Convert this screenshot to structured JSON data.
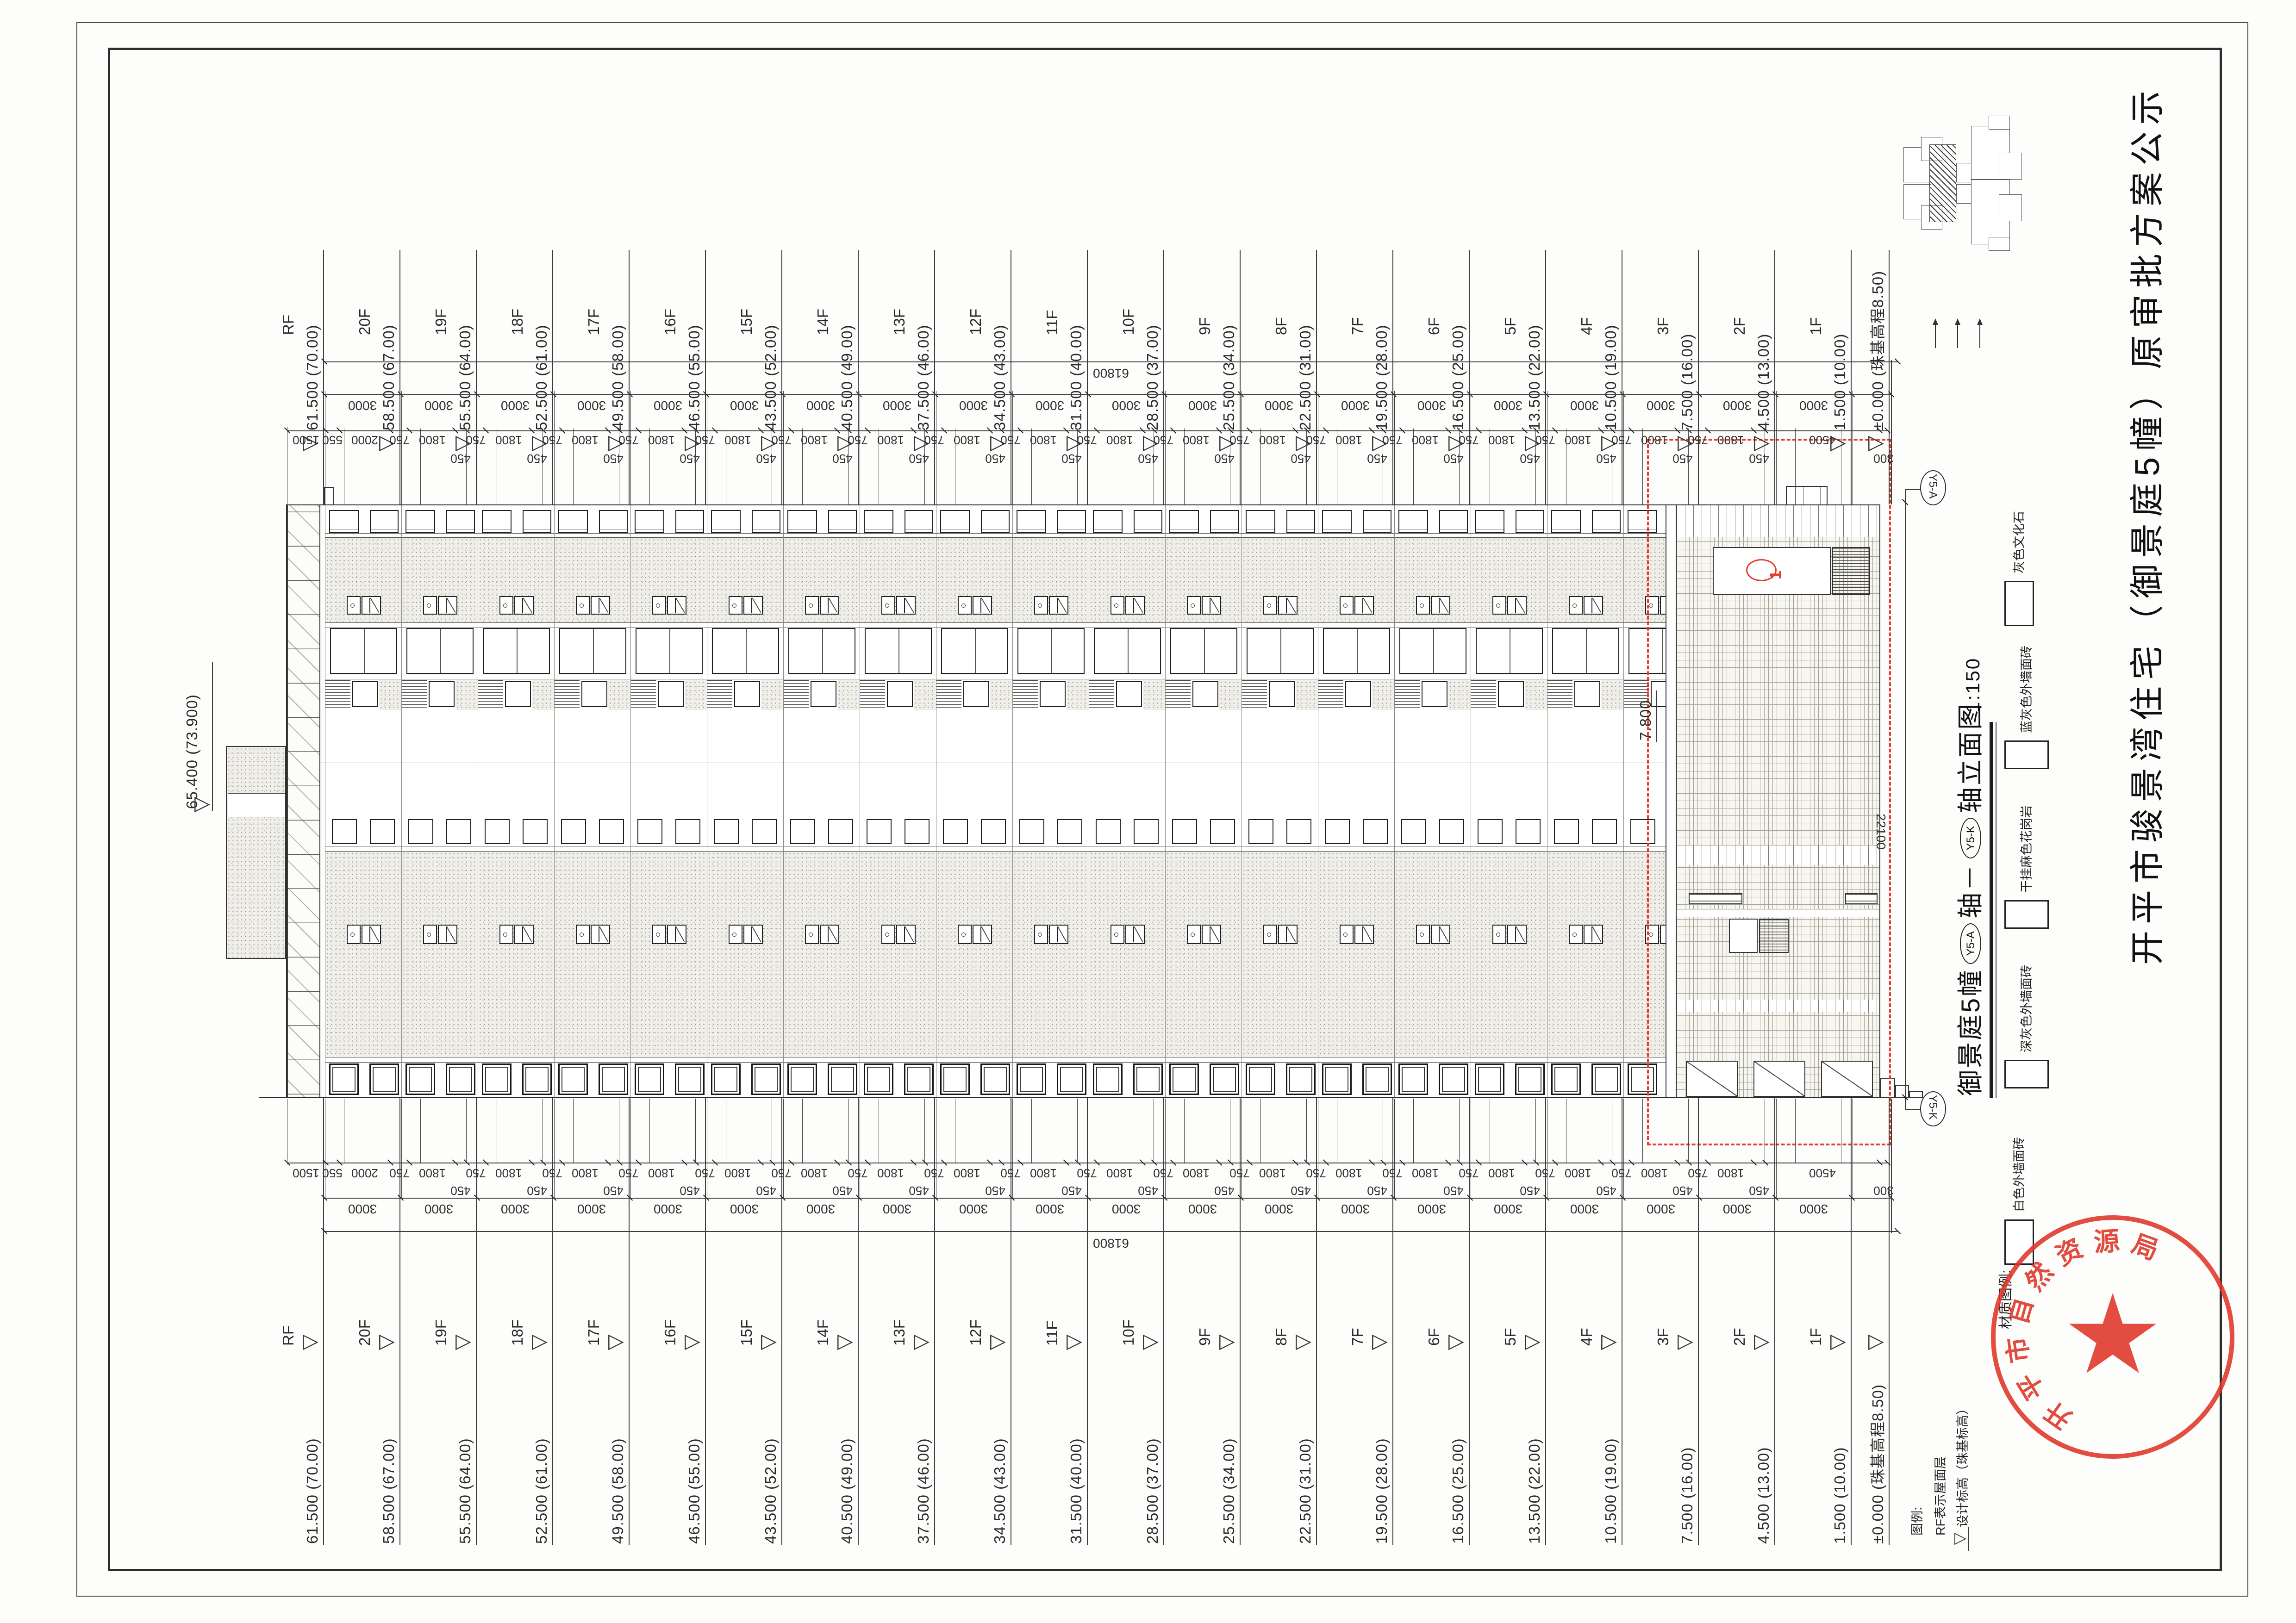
{
  "page_title": "开平市骏景湾住宅（御景庭5幢）原审批方案公示",
  "drawing_title": {
    "project": "御景庭5幢",
    "axis_a": "Y5-A",
    "mid": "轴－",
    "axis_k": "Y5-K",
    "end": "轴立面图",
    "scale": "1:150"
  },
  "legend": {
    "header": "材质图例:",
    "items": [
      {
        "label": "灰色文化石",
        "pattern": "brick",
        "portrait": true
      },
      {
        "label": "蓝灰色外墙面砖",
        "pattern": "diagpat",
        "portrait": false
      },
      {
        "label": "干挂麻色花岗岩",
        "pattern": "hlines",
        "portrait": false
      },
      {
        "label": "深灰色外墙面砖",
        "pattern": "stipple",
        "portrait": false
      },
      {
        "label": "白色外墙面砖",
        "pattern": "plain",
        "portrait": true
      }
    ]
  },
  "notes": [
    "图例:",
    "RF表示屋面层",
    "设计标高（珠基标高）"
  ],
  "stamp_text": "开平市自然资源局",
  "revision_mark": "1",
  "axis_bubbles": [
    "Y5-A",
    "Y5-K"
  ],
  "levels": {
    "floors": [
      {
        "name": "RF",
        "elev": "61.500",
        "abs": "(70.00)"
      },
      {
        "name": "20F",
        "elev": "58.500",
        "abs": "(67.00)"
      },
      {
        "name": "19F",
        "elev": "55.500",
        "abs": "(64.00)"
      },
      {
        "name": "18F",
        "elev": "52.500",
        "abs": "(61.00)"
      },
      {
        "name": "17F",
        "elev": "49.500",
        "abs": "(58.00)"
      },
      {
        "name": "16F",
        "elev": "46.500",
        "abs": "(55.00)"
      },
      {
        "name": "15F",
        "elev": "43.500",
        "abs": "(52.00)"
      },
      {
        "name": "14F",
        "elev": "40.500",
        "abs": "(49.00)"
      },
      {
        "name": "13F",
        "elev": "37.500",
        "abs": "(46.00)"
      },
      {
        "name": "12F",
        "elev": "34.500",
        "abs": "(43.00)"
      },
      {
        "name": "11F",
        "elev": "31.500",
        "abs": "(40.00)"
      },
      {
        "name": "10F",
        "elev": "28.500",
        "abs": "(37.00)"
      },
      {
        "name": "9F",
        "elev": "25.500",
        "abs": "(34.00)"
      },
      {
        "name": "8F",
        "elev": "22.500",
        "abs": "(31.00)"
      },
      {
        "name": "7F",
        "elev": "19.500",
        "abs": "(28.00)"
      },
      {
        "name": "6F",
        "elev": "16.500",
        "abs": "(25.00)"
      },
      {
        "name": "5F",
        "elev": "13.500",
        "abs": "(22.00)"
      },
      {
        "name": "4F",
        "elev": "10.500",
        "abs": "(19.00)"
      },
      {
        "name": "3F",
        "elev": "7.500",
        "abs": "(16.00)"
      },
      {
        "name": "2F",
        "elev": "4.500",
        "abs": "(13.00)"
      },
      {
        "name": "1F",
        "elev": "1.500",
        "abs": "(10.00)"
      }
    ],
    "base": {
      "elev": "±0.000",
      "abs": "(珠基高程8.50)"
    },
    "penthouse": {
      "elev": "65.400",
      "abs": "(73.900)"
    },
    "canopy": "7.800"
  },
  "dims": {
    "overall": "61800",
    "width": "22100",
    "module": "3000",
    "module_count": 20,
    "fine_lead": [
      "1500",
      "550",
      "2000"
    ],
    "fine_repeat": [
      "750",
      "1800",
      "450"
    ],
    "fine_repeat_count": 18,
    "fine_tail": [
      "4500",
      "300"
    ]
  }
}
